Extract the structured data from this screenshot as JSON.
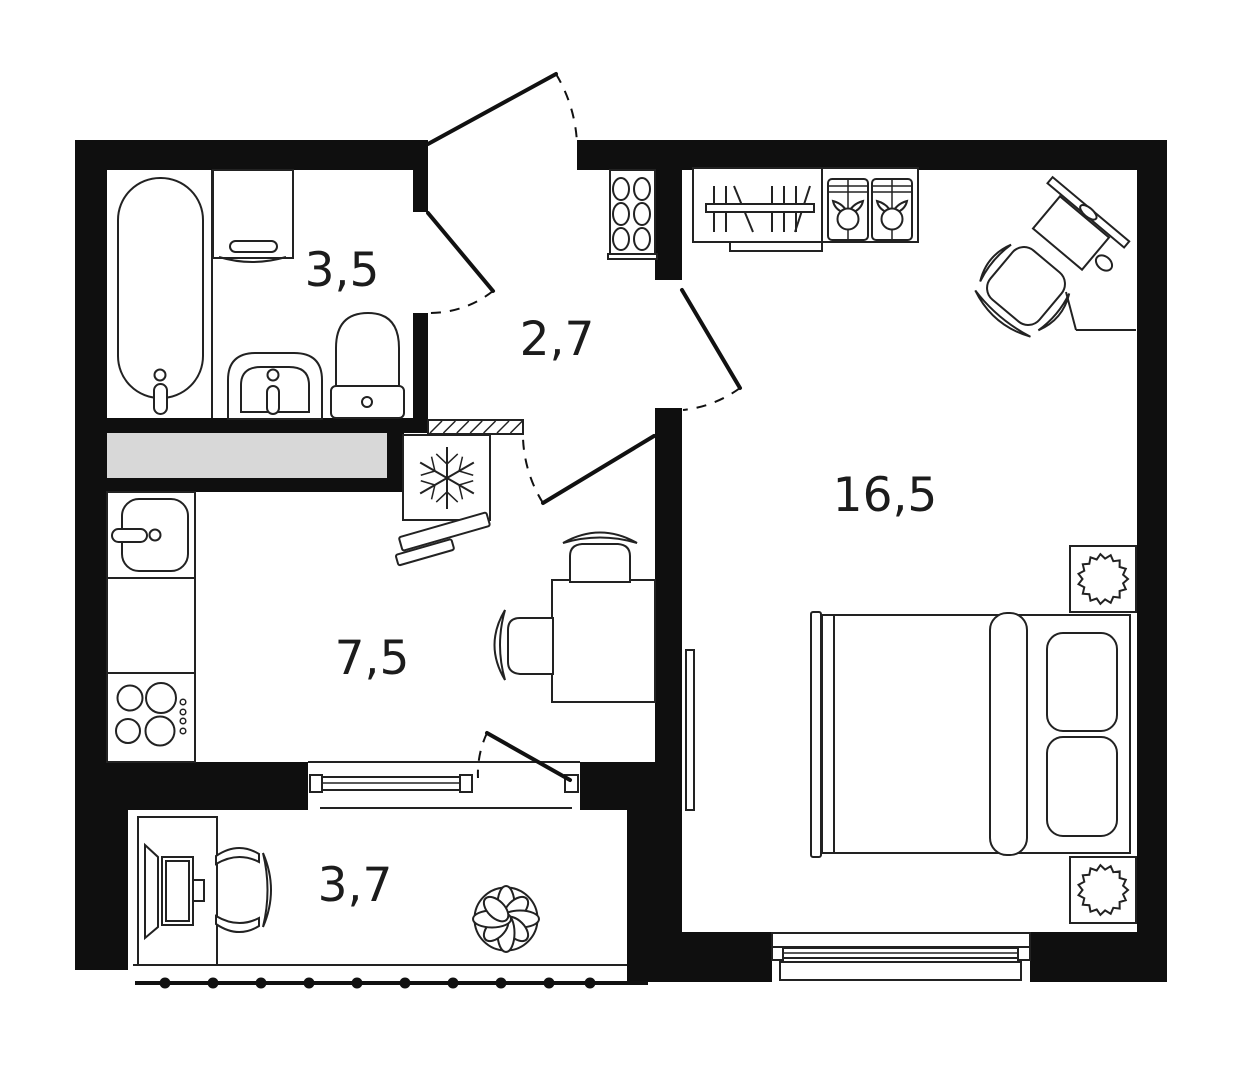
{
  "colors": {
    "background": "#ffffff",
    "walls": "#0f0f0f",
    "furniture_lines": "#222222",
    "duct_fill": "#d8d8d8",
    "label_text": "#1c1c1c"
  },
  "rooms": {
    "bathroom": {
      "name": "bathroom",
      "label": "3,5"
    },
    "hallway": {
      "name": "hallway",
      "label": "2,7"
    },
    "kitchen": {
      "name": "kitchen",
      "label": "7,5"
    },
    "living_room": {
      "name": "living-room",
      "label": "16,5"
    },
    "balcony": {
      "name": "balcony",
      "label": "3,7"
    }
  },
  "icons": [
    "bathtub-icon",
    "washing-machine-icon",
    "bathroom-sink-icon",
    "toilet-icon",
    "duct-shaft-icon",
    "vent-hatch-icon",
    "fridge-snowflake-icon",
    "kitchen-sink-icon",
    "stove-icon",
    "dining-table-icon",
    "chair-icon",
    "shoe-rack-icon",
    "wardrobe-icon",
    "storage-box-icon",
    "corner-desk-icon",
    "monitor-icon",
    "office-chair-icon",
    "double-bed-icon",
    "pillow-icon",
    "nightstand-lamp-icon",
    "radiator-icon",
    "balcony-desk-icon",
    "computer-icon",
    "balcony-chair-icon",
    "plant-icon",
    "railing-icon",
    "door-swing-icon",
    "window-icon"
  ]
}
